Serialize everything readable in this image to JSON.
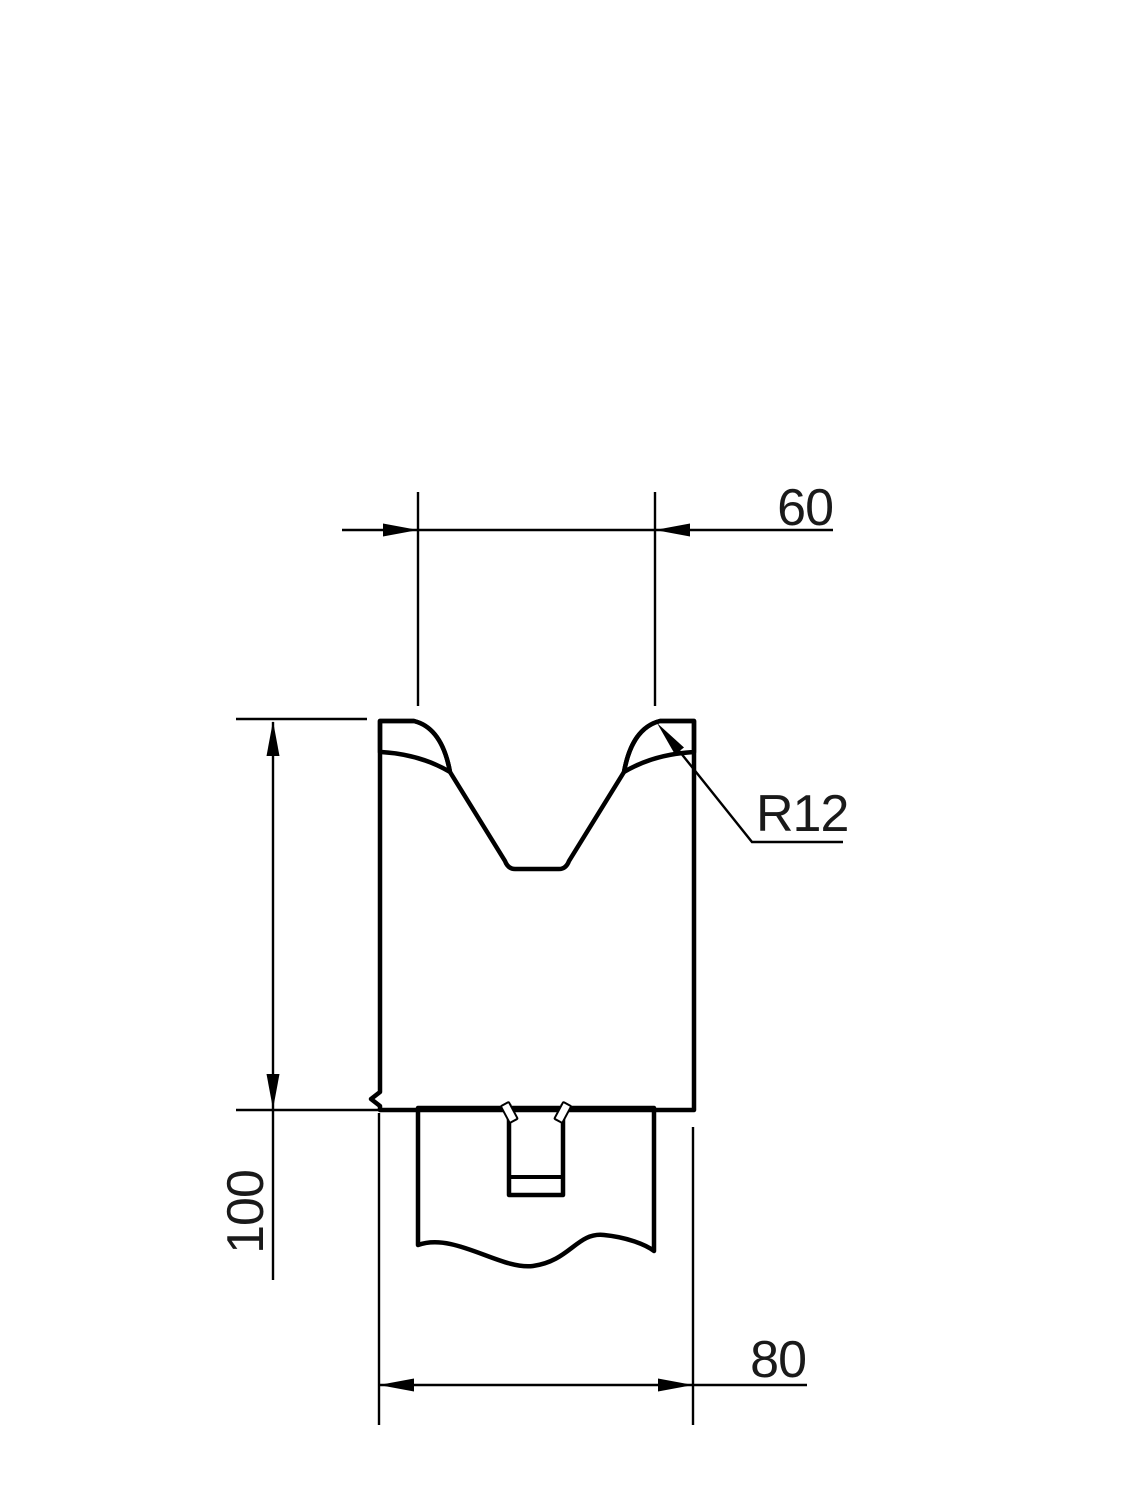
{
  "drawing": {
    "type": "technical-drawing",
    "subject": "press-brake V-die cross section",
    "dimensions": {
      "top_width": "60",
      "height": "100",
      "bottom_width": "80",
      "corner_radius": "R12"
    },
    "colors": {
      "background": "#ffffff",
      "line": "#000000",
      "body_top": "#929292",
      "body_bottom": "#6f6f6f",
      "corner_dark": "#454545",
      "tang": "#c2c2c2",
      "slot_top": "#7a7a7a",
      "slot_bottom": "#585858",
      "highlight": "#ffffff"
    }
  }
}
